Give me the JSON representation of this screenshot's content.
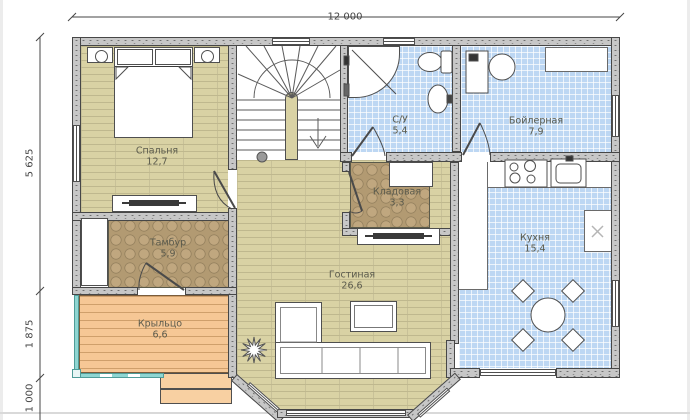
{
  "plan": {
    "type": "floor-plan-drawing",
    "dimensions": {
      "top_width": "12 000",
      "left": [
        "5 625",
        "1 875",
        "1 000"
      ]
    },
    "rooms": [
      {
        "id": "bedroom",
        "name": "Спальня",
        "area": "12,7"
      },
      {
        "id": "bathroom",
        "name": "С/У",
        "area": "5,4"
      },
      {
        "id": "boiler",
        "name": "Бойлерная",
        "area": "7,9"
      },
      {
        "id": "storage",
        "name": "Кладовая",
        "area": "3,3"
      },
      {
        "id": "vestibule",
        "name": "Тамбур",
        "area": "5,9"
      },
      {
        "id": "living",
        "name": "Гостиная",
        "area": "26,6"
      },
      {
        "id": "kitchen",
        "name": "Кухня",
        "area": "15,4"
      },
      {
        "id": "porch",
        "name": "Крыльцо",
        "area": "6,6"
      }
    ],
    "colors": {
      "wall": "#c7c7c7",
      "wood_floor": "#d9d2a4",
      "blue_tile": "#bdd7f3",
      "brown_tile": "#b29a72",
      "deck": "#f6c795",
      "railing": "#8fd6d2",
      "label_text": "#5a5a4c",
      "dimension_text": "#454545"
    },
    "furniture": [
      "bed",
      "nightstands",
      "dresser-tv",
      "stairs-down",
      "shower",
      "toilet",
      "washbasin",
      "boiler-unit",
      "water-tank",
      "stove",
      "kitchen-sink",
      "dining-table-4-chairs",
      "l-sofa",
      "coffee-table",
      "tv-stand",
      "plant",
      "wardrobe",
      "closet"
    ]
  }
}
